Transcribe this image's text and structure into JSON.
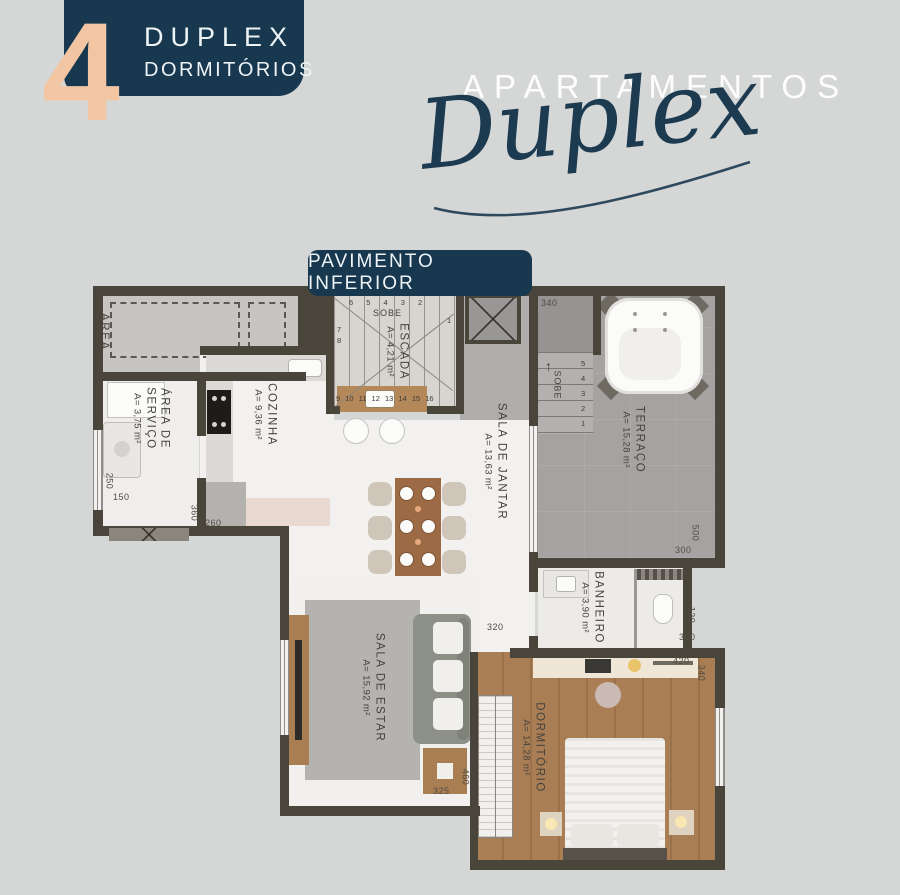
{
  "header": {
    "unit_count": "4",
    "badge_line1": "DUPLEX",
    "badge_line2": "DORMITÓRIOS",
    "title": "APARTAMENTOS",
    "script_title": "Duplex"
  },
  "floor_badge": "PAVIMENTO INFERIOR",
  "rooms": [
    {
      "name": "ÁREA",
      "area": ""
    },
    {
      "name": "ÁREA DE SERVIÇO",
      "area": "A= 3,75 m²"
    },
    {
      "name": "COZINHA",
      "area": "A= 9,36 m²"
    },
    {
      "name": "ESCADA",
      "area": "A= 4,21 m²"
    },
    {
      "name": "SALA DE JANTAR",
      "area": "A= 13,63 m²"
    },
    {
      "name": "TERRAÇO",
      "area": "A= 15,28 m²"
    },
    {
      "name": "BANHEIRO",
      "area": "A= 3,90 m²"
    },
    {
      "name": "SALA DE ESTAR",
      "area": "A= 15,92 m²"
    },
    {
      "name": "DORMITÓRIO",
      "area": "A= 14,28 m²"
    }
  ],
  "stairs": {
    "sobe_main": "SOBE",
    "sobe_terrace": "SOBE",
    "arrow_up": "↑",
    "steps_top": "6 5 4 3 2",
    "steps_left": "7 8",
    "steps_bottom": "9 10 11 12 13 14 15 16",
    "steps_right": "1",
    "terrace_steps": "5 4 3 2 1"
  },
  "dimensions": {
    "terrace_top": "340",
    "service_left_v": "250",
    "service_left_h": "150",
    "kitchen_bottom_v": "360",
    "kitchen_bottom_h": "260",
    "terrace_bottom_v": "500",
    "terrace_bottom_h": "300",
    "bath_right_v": "130",
    "bath_right_h": "300",
    "bedroom_right_h": "420",
    "bedroom_right_v": "340",
    "hall_h": "320",
    "living_bottom_h": "325",
    "living_bottom_v": "460"
  },
  "colors": {
    "navy": "#17384f",
    "peach": "#f2c6a2",
    "background": "#d5d7d6",
    "wall": "#4a453b"
  }
}
